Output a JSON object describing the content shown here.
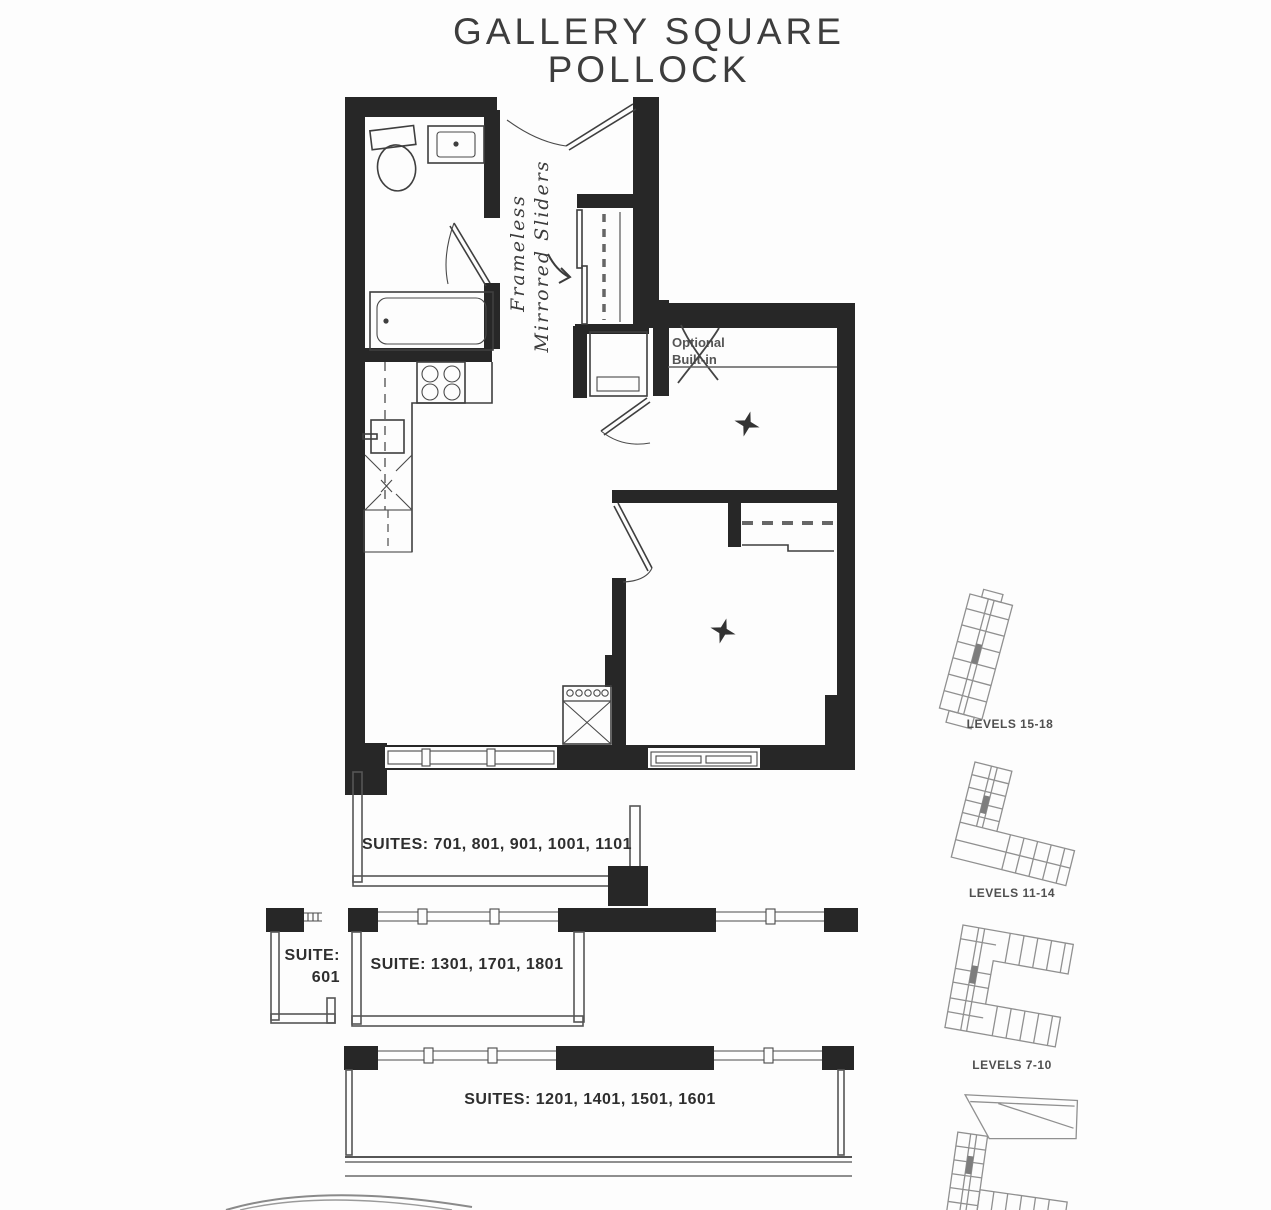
{
  "title": {
    "line1": "GALLERY SQUARE",
    "line2": "POLLOCK"
  },
  "annotations": {
    "closet_note_line1": "Frameless",
    "closet_note_line2": "Mirrored Sliders",
    "optional_builtin_line1": "Optional",
    "optional_builtin_line2": "Built-in"
  },
  "suites": {
    "balcony_top": "SUITES: 701, 801, 901, 1001, 1101",
    "balcony_small_line1": "SUITE:",
    "balcony_small_line2": "601",
    "balcony_mid": "SUITE: 1301, 1701, 1801",
    "balcony_bottom": "SUITES: 1201, 1401, 1501, 1601"
  },
  "keyplans": [
    {
      "label": "LEVELS 15-18"
    },
    {
      "label": "LEVELS 11-14"
    },
    {
      "label": "LEVELS 7-10"
    }
  ],
  "colors": {
    "ink": "#272727",
    "line": "#3f3f3f",
    "rail": "#565656",
    "keyplan": "#909090"
  }
}
